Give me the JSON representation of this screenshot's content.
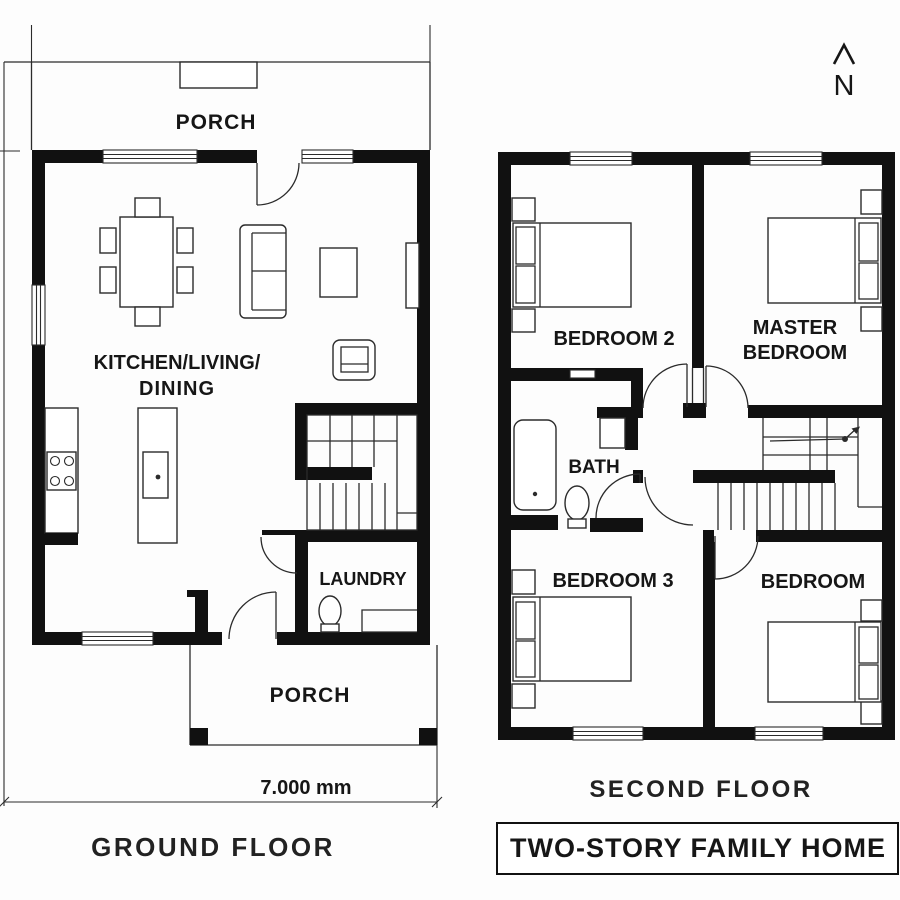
{
  "colors": {
    "ink": "#111111",
    "line": "#2b2b2b",
    "paper": "#ffffff"
  },
  "north_indicator": {
    "label": "N"
  },
  "ground_floor": {
    "caption": "GROUND FLOOR",
    "dimension_label": "7.000 mm",
    "rooms": {
      "porch_top": "PORCH",
      "kitchen_living_line1": "KITCHEN/LIVING/",
      "kitchen_living_line2": "DINING",
      "laundry": "LAUNDRY",
      "porch_bottom": "PORCH"
    }
  },
  "second_floor": {
    "caption": "SECOND FLOOR",
    "rooms": {
      "bedroom2": "BEDROOM 2",
      "master_line1": "MASTER",
      "master_line2": "BEDROOM",
      "bath": "BATH",
      "bedroom3": "BEDROOM 3",
      "bedroom": "BEDROOM"
    }
  },
  "title_block": {
    "text": "TWO-STORY FAMILY HOME"
  }
}
